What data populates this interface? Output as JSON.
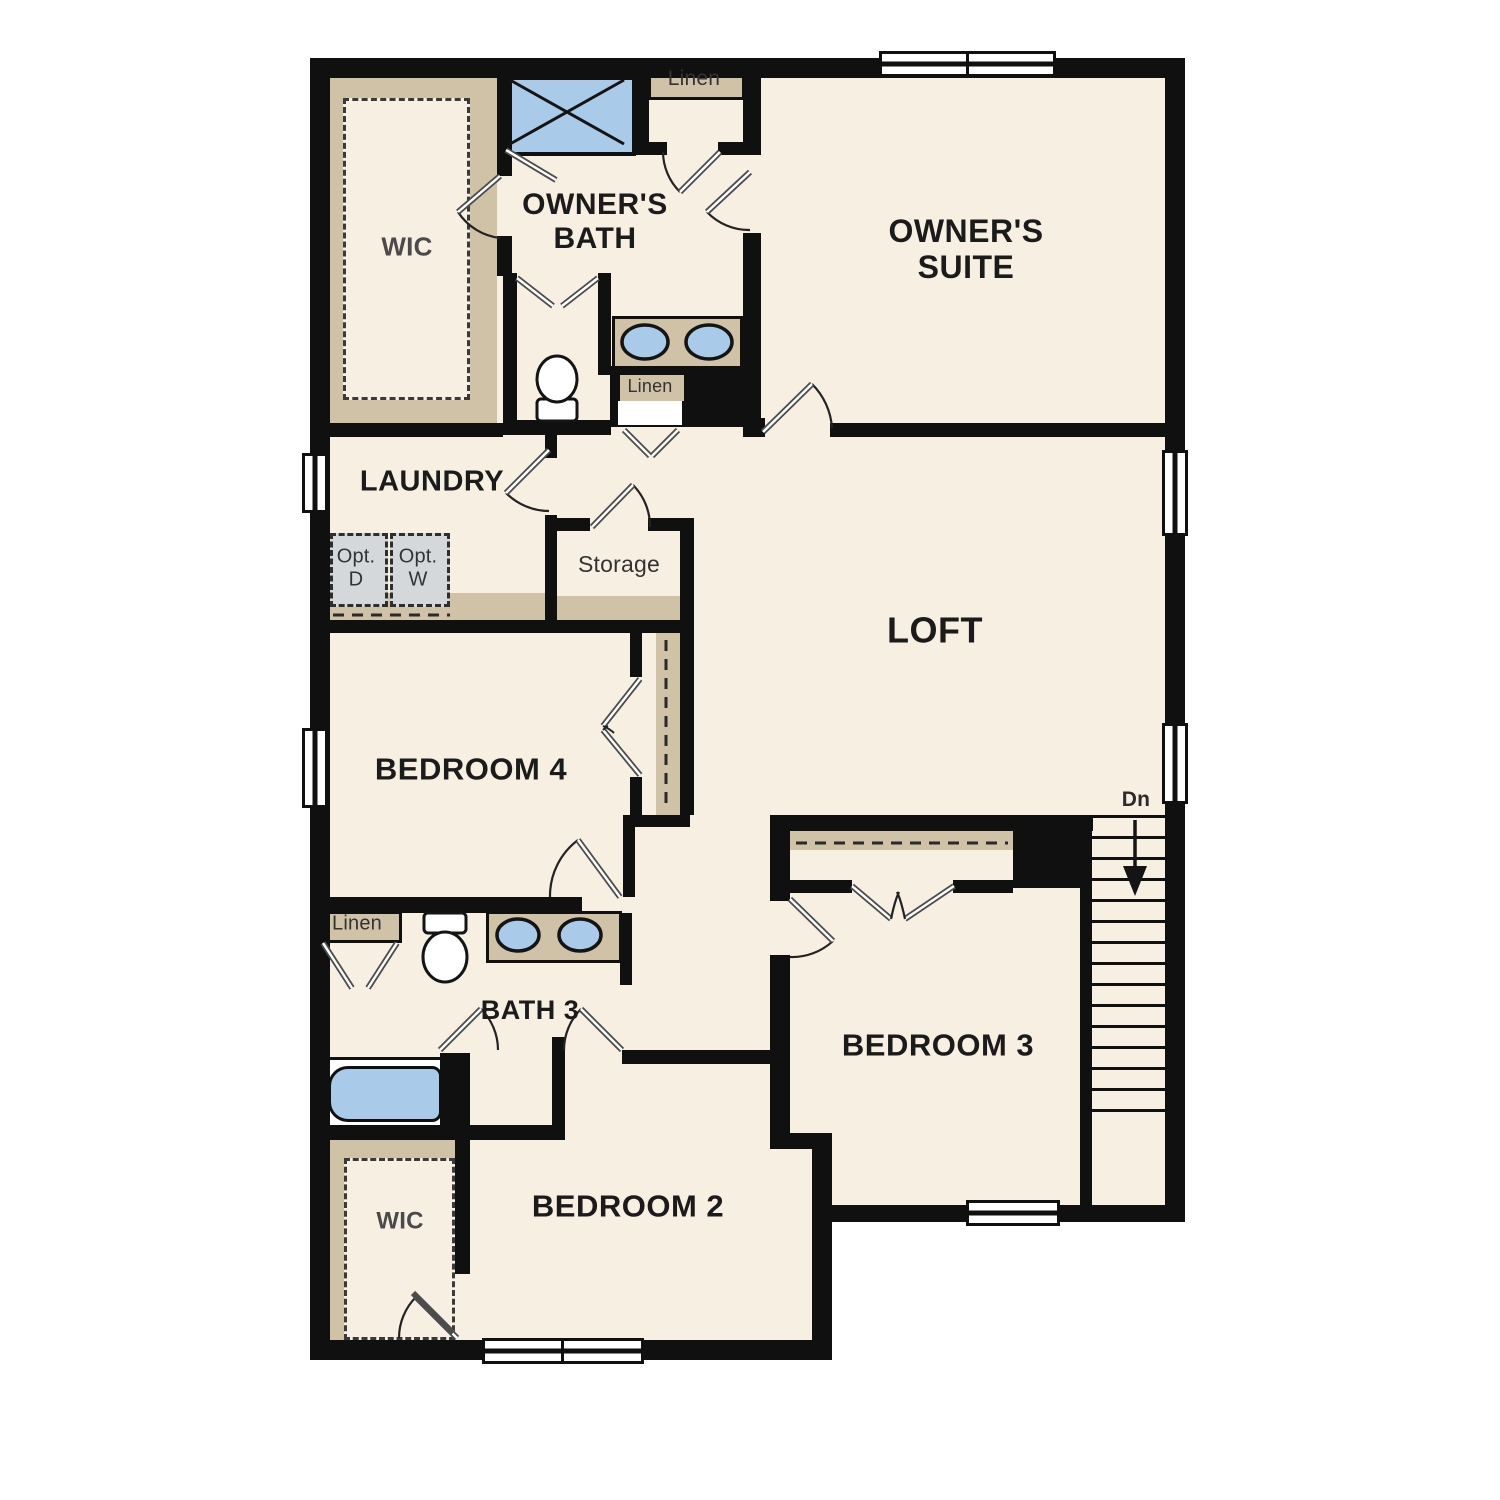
{
  "colors": {
    "wall": "#101010",
    "floor": "#f6efe2",
    "tan": "#cfc2a6",
    "blue": "#a9cae8",
    "gray": "#d5d8da"
  },
  "labels": {
    "wic_top": "WIC",
    "owners_bath": "OWNER'S\nBATH",
    "linen_top": "Linen",
    "owners_suite": "OWNER'S\nSUITE",
    "laundry": "LAUNDRY",
    "opt_d": "Opt.\nD",
    "opt_w": "Opt.\nW",
    "storage": "Storage",
    "linen_mid": "Linen",
    "loft": "LOFT",
    "bedroom4": "BEDROOM 4",
    "dn": "Dn",
    "linen_bath3": "Linen",
    "bath3": "BATH 3",
    "bedroom3": "BEDROOM 3",
    "bedroom2": "BEDROOM 2",
    "wic_bottom": "WIC"
  }
}
